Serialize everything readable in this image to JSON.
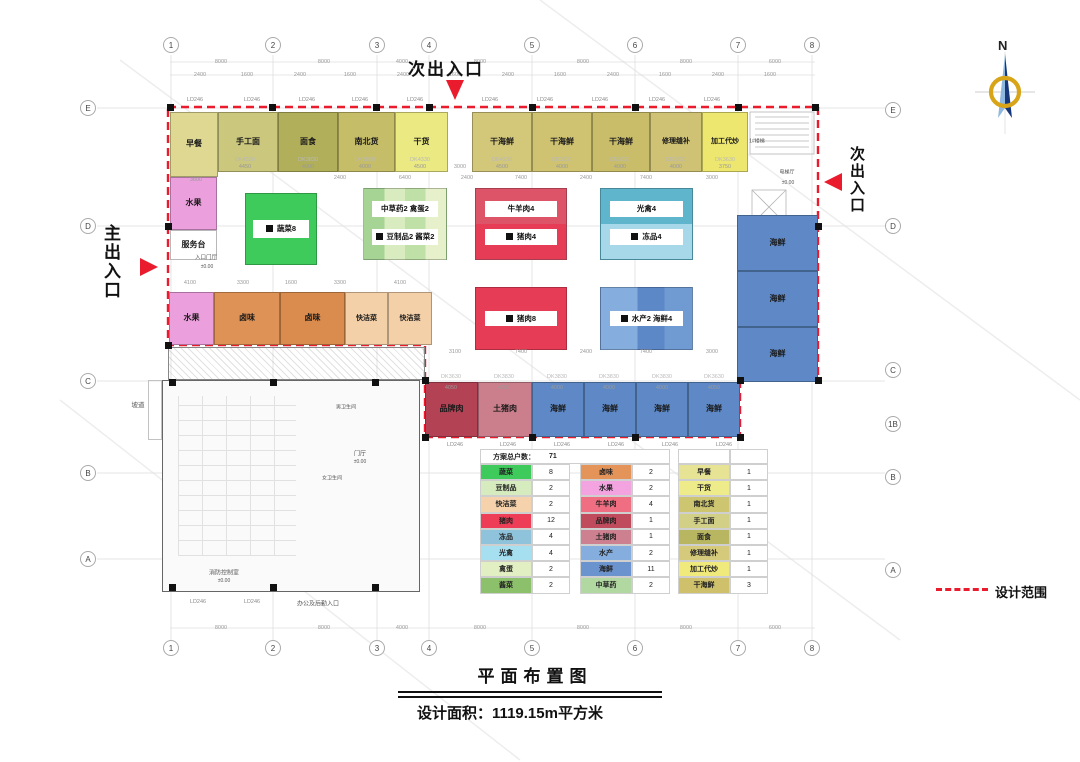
{
  "page": {
    "north_label": "N",
    "legend_label": "设计范围",
    "title": "平面布置图",
    "area_text": "设计面积：1119.15m平方米"
  },
  "entrances": {
    "top": "次出入口",
    "right": "次出入口",
    "left": "主出入口"
  },
  "grid": {
    "top": [
      {
        "n": "1",
        "x": 171
      },
      {
        "n": "2",
        "x": 273
      },
      {
        "n": "3",
        "x": 377
      },
      {
        "n": "4",
        "x": 429
      },
      {
        "n": "5",
        "x": 532
      },
      {
        "n": "6",
        "x": 635
      },
      {
        "n": "7",
        "x": 738
      },
      {
        "n": "8",
        "x": 812
      }
    ],
    "bottom": [
      {
        "n": "1",
        "x": 171
      },
      {
        "n": "2",
        "x": 273
      },
      {
        "n": "3",
        "x": 377
      },
      {
        "n": "4",
        "x": 429
      },
      {
        "n": "5",
        "x": 532
      },
      {
        "n": "6",
        "x": 635
      },
      {
        "n": "7",
        "x": 738
      },
      {
        "n": "8",
        "x": 812
      }
    ],
    "left": [
      {
        "n": "E",
        "y": 108
      },
      {
        "n": "D",
        "y": 226
      },
      {
        "n": "C",
        "y": 381
      },
      {
        "n": "B",
        "y": 473
      },
      {
        "n": "A",
        "y": 559
      }
    ],
    "right": [
      {
        "n": "E",
        "y": 110
      },
      {
        "n": "D",
        "y": 226
      },
      {
        "n": "C",
        "y": 370
      },
      {
        "n": "1B",
        "y": 424
      },
      {
        "n": "B",
        "y": 477
      },
      {
        "n": "A",
        "y": 570
      }
    ]
  },
  "plan": {
    "boundary_color": "#ea1b2d",
    "stalls": [
      {
        "label": "早餐",
        "x": 170,
        "y": 112,
        "w": 48,
        "h": 65,
        "bg": "#ded892"
      },
      {
        "label": "手工面",
        "x": 218,
        "y": 112,
        "w": 60,
        "h": 60,
        "bg": "#cbc77c"
      },
      {
        "label": "面食",
        "x": 278,
        "y": 112,
        "w": 60,
        "h": 60,
        "bg": "#b2af5a"
      },
      {
        "label": "南北货",
        "x": 338,
        "y": 112,
        "w": 57,
        "h": 60,
        "bg": "#c6bd69"
      },
      {
        "label": "干货",
        "x": 395,
        "y": 112,
        "w": 53,
        "h": 60,
        "bg": "#ebe982"
      },
      {
        "label": "干海鲜",
        "x": 472,
        "y": 112,
        "w": 60,
        "h": 60,
        "bg": "#d3c77a"
      },
      {
        "label": "干海鲜",
        "x": 532,
        "y": 112,
        "w": 60,
        "h": 60,
        "bg": "#cfc372"
      },
      {
        "label": "干海鲜",
        "x": 592,
        "y": 112,
        "w": 58,
        "h": 60,
        "bg": "#c9bd6a"
      },
      {
        "label": "修理缝补",
        "x": 650,
        "y": 112,
        "w": 52,
        "h": 60,
        "bg": "#cfc275",
        "fs": 7
      },
      {
        "label": "加工代炒",
        "x": 702,
        "y": 112,
        "w": 46,
        "h": 60,
        "bg": "#ede76f",
        "fs": 7
      },
      {
        "label": "水果",
        "x": 170,
        "y": 177,
        "w": 47,
        "h": 53,
        "bg": "#eb9fdc"
      },
      {
        "label": "服务台",
        "x": 170,
        "y": 230,
        "w": 47,
        "h": 30,
        "bg": "#ffffff"
      },
      {
        "label": "水果",
        "x": 169,
        "y": 292,
        "w": 45,
        "h": 53,
        "bg": "#eb9fdc"
      },
      {
        "label": "卤味",
        "x": 214,
        "y": 292,
        "w": 66,
        "h": 53,
        "bg": "#de9256"
      },
      {
        "label": "卤味",
        "x": 280,
        "y": 292,
        "w": 65,
        "h": 53,
        "bg": "#d98c4e"
      },
      {
        "label": "快洁菜",
        "x": 345,
        "y": 292,
        "w": 43,
        "h": 53,
        "bg": "#f4d0a8",
        "fs": 7
      },
      {
        "label": "快洁菜",
        "x": 388,
        "y": 292,
        "w": 44,
        "h": 53,
        "bg": "#f4d0a8",
        "fs": 7
      },
      {
        "label": "品牌肉",
        "x": 425,
        "y": 382,
        "w": 53,
        "h": 55,
        "bg": "#b24254"
      },
      {
        "label": "土猪肉",
        "x": 478,
        "y": 382,
        "w": 54,
        "h": 55,
        "bg": "#cb7f8d"
      },
      {
        "label": "海鲜",
        "x": 532,
        "y": 382,
        "w": 52,
        "h": 55,
        "bg": "#5e89c6"
      },
      {
        "label": "海鲜",
        "x": 584,
        "y": 382,
        "w": 52,
        "h": 55,
        "bg": "#5e89c6"
      },
      {
        "label": "海鲜",
        "x": 636,
        "y": 382,
        "w": 52,
        "h": 55,
        "bg": "#5e89c6"
      },
      {
        "label": "海鲜",
        "x": 688,
        "y": 382,
        "w": 52,
        "h": 55,
        "bg": "#5e89c6"
      },
      {
        "label": "海鲜",
        "x": 737,
        "y": 215,
        "w": 81,
        "h": 56,
        "bg": "#5e89c6"
      },
      {
        "label": "海鲜",
        "x": 737,
        "y": 271,
        "w": 81,
        "h": 56,
        "bg": "#5e89c6"
      },
      {
        "label": "海鲜",
        "x": 737,
        "y": 327,
        "w": 81,
        "h": 55,
        "bg": "#5e89c6"
      }
    ],
    "islands": [
      {
        "labels": [
          "蔬菜8"
        ],
        "x": 245,
        "y": 193,
        "w": 72,
        "h": 72,
        "bg": "#3fcb5c"
      },
      {
        "labels": [
          "中草药2  禽蛋2",
          "豆制品2  酱菜2"
        ],
        "x": 363,
        "y": 188,
        "w": 84,
        "h": 72,
        "bg": "linear-gradient(90deg,#a6d494 0 25%,#d9ecc0 0 50%,#bfe0a6 0 75%,#e6f0ca 0 100%)"
      },
      {
        "labels": [
          "牛羊肉4",
          "猪肉4"
        ],
        "x": 475,
        "y": 188,
        "w": 92,
        "h": 72,
        "bg": "#dd5368",
        "bg2": "#e63c55"
      },
      {
        "labels": [
          "光禽4",
          "冻品4"
        ],
        "x": 600,
        "y": 188,
        "w": 93,
        "h": 72,
        "bg": "#5fb6cc",
        "bg2": "#a7d8e9"
      },
      {
        "labels": [
          "猪肉8"
        ],
        "x": 475,
        "y": 287,
        "w": 92,
        "h": 63,
        "bg": "#e63c55"
      },
      {
        "labels": [
          "水产2  海鲜4"
        ],
        "x": 600,
        "y": 287,
        "w": 93,
        "h": 63,
        "bg": "linear-gradient(90deg,#85aede 0 40%,#5c88c8 0 70%,#6f9ad2 0 100%)"
      }
    ],
    "columns": [
      [
        170,
        107
      ],
      [
        272,
        107
      ],
      [
        376,
        107
      ],
      [
        429,
        107
      ],
      [
        532,
        107
      ],
      [
        635,
        107
      ],
      [
        738,
        107
      ],
      [
        815,
        107
      ],
      [
        168,
        226
      ],
      [
        168,
        345
      ],
      [
        818,
        226
      ],
      [
        818,
        380
      ],
      [
        740,
        380
      ],
      [
        425,
        380
      ],
      [
        425,
        437
      ],
      [
        532,
        437
      ],
      [
        635,
        437
      ],
      [
        740,
        437
      ],
      [
        172,
        382
      ],
      [
        273,
        382
      ],
      [
        375,
        382
      ],
      [
        172,
        587
      ],
      [
        273,
        587
      ],
      [
        375,
        587
      ]
    ],
    "window_labels": [
      {
        "t": "LD246",
        "x": 195,
        "y": 100
      },
      {
        "t": "LD246",
        "x": 252,
        "y": 100
      },
      {
        "t": "LD246",
        "x": 307,
        "y": 100
      },
      {
        "t": "LD246",
        "x": 360,
        "y": 100
      },
      {
        "t": "LD246",
        "x": 415,
        "y": 100
      },
      {
        "t": "LD246",
        "x": 490,
        "y": 100
      },
      {
        "t": "LD246",
        "x": 545,
        "y": 100
      },
      {
        "t": "LD246",
        "x": 600,
        "y": 100
      },
      {
        "t": "LD246",
        "x": 657,
        "y": 100
      },
      {
        "t": "LD246",
        "x": 712,
        "y": 100
      },
      {
        "t": "LD246",
        "x": 455,
        "y": 445
      },
      {
        "t": "LD246",
        "x": 508,
        "y": 445
      },
      {
        "t": "LD246",
        "x": 562,
        "y": 445
      },
      {
        "t": "LD246",
        "x": 616,
        "y": 445
      },
      {
        "t": "LD246",
        "x": 670,
        "y": 445
      },
      {
        "t": "LD246",
        "x": 724,
        "y": 445
      },
      {
        "t": "LD246",
        "x": 198,
        "y": 602
      },
      {
        "t": "LD246",
        "x": 252,
        "y": 602
      }
    ],
    "dk_labels": [
      {
        "t": "DK4330",
        "x": 245,
        "y": 160
      },
      {
        "t": "DK3830",
        "x": 308,
        "y": 160
      },
      {
        "t": "DK3830",
        "x": 365,
        "y": 160
      },
      {
        "t": "DK4330",
        "x": 420,
        "y": 160
      },
      {
        "t": "DK4330",
        "x": 502,
        "y": 160
      },
      {
        "t": "DK3830",
        "x": 562,
        "y": 160
      },
      {
        "t": "DK3830",
        "x": 620,
        "y": 160
      },
      {
        "t": "DK3830",
        "x": 676,
        "y": 160
      },
      {
        "t": "DK3630",
        "x": 725,
        "y": 160
      },
      {
        "t": "DK3630",
        "x": 451,
        "y": 377
      },
      {
        "t": "DK3830",
        "x": 504,
        "y": 377
      },
      {
        "t": "DK3830",
        "x": 557,
        "y": 377
      },
      {
        "t": "DK3830",
        "x": 609,
        "y": 377
      },
      {
        "t": "DK3830",
        "x": 662,
        "y": 377
      },
      {
        "t": "DK3630",
        "x": 714,
        "y": 377
      }
    ],
    "dims": [
      {
        "t": "8000",
        "x": 221,
        "y": 62
      },
      {
        "t": "8000",
        "x": 324,
        "y": 62
      },
      {
        "t": "4000",
        "x": 402,
        "y": 62
      },
      {
        "t": "8000",
        "x": 480,
        "y": 62
      },
      {
        "t": "8000",
        "x": 583,
        "y": 62
      },
      {
        "t": "8000",
        "x": 686,
        "y": 62
      },
      {
        "t": "6000",
        "x": 775,
        "y": 62
      },
      {
        "t": "2400",
        "x": 200,
        "y": 75
      },
      {
        "t": "1600",
        "x": 247,
        "y": 75
      },
      {
        "t": "2400",
        "x": 300,
        "y": 75
      },
      {
        "t": "1600",
        "x": 350,
        "y": 75
      },
      {
        "t": "2400",
        "x": 403,
        "y": 75
      },
      {
        "t": "1600",
        "x": 455,
        "y": 75
      },
      {
        "t": "2400",
        "x": 508,
        "y": 75
      },
      {
        "t": "1600",
        "x": 560,
        "y": 75
      },
      {
        "t": "2400",
        "x": 613,
        "y": 75
      },
      {
        "t": "1600",
        "x": 665,
        "y": 75
      },
      {
        "t": "2400",
        "x": 718,
        "y": 75
      },
      {
        "t": "1600",
        "x": 770,
        "y": 75
      },
      {
        "t": "4450",
        "x": 245,
        "y": 167
      },
      {
        "t": "4000",
        "x": 308,
        "y": 167
      },
      {
        "t": "4000",
        "x": 365,
        "y": 167
      },
      {
        "t": "4500",
        "x": 420,
        "y": 167
      },
      {
        "t": "3000",
        "x": 460,
        "y": 167
      },
      {
        "t": "4500",
        "x": 502,
        "y": 167
      },
      {
        "t": "4000",
        "x": 562,
        "y": 167
      },
      {
        "t": "4000",
        "x": 620,
        "y": 167
      },
      {
        "t": "4000",
        "x": 676,
        "y": 167
      },
      {
        "t": "3750",
        "x": 725,
        "y": 167
      },
      {
        "t": "3600",
        "x": 196,
        "y": 180
      },
      {
        "t": "2400",
        "x": 340,
        "y": 178
      },
      {
        "t": "6400",
        "x": 405,
        "y": 178
      },
      {
        "t": "2400",
        "x": 467,
        "y": 178
      },
      {
        "t": "7400",
        "x": 521,
        "y": 178
      },
      {
        "t": "2400",
        "x": 586,
        "y": 178
      },
      {
        "t": "7400",
        "x": 646,
        "y": 178
      },
      {
        "t": "3000",
        "x": 712,
        "y": 178
      },
      {
        "t": "4100",
        "x": 190,
        "y": 283
      },
      {
        "t": "3300",
        "x": 243,
        "y": 283
      },
      {
        "t": "1600",
        "x": 291,
        "y": 283
      },
      {
        "t": "3300",
        "x": 340,
        "y": 283
      },
      {
        "t": "4100",
        "x": 400,
        "y": 283
      },
      {
        "t": "3100",
        "x": 455,
        "y": 352
      },
      {
        "t": "7400",
        "x": 521,
        "y": 352
      },
      {
        "t": "2400",
        "x": 586,
        "y": 352
      },
      {
        "t": "7400",
        "x": 646,
        "y": 352
      },
      {
        "t": "3000",
        "x": 712,
        "y": 352
      },
      {
        "t": "4050",
        "x": 451,
        "y": 388
      },
      {
        "t": "4000",
        "x": 504,
        "y": 388
      },
      {
        "t": "4000",
        "x": 557,
        "y": 388
      },
      {
        "t": "4000",
        "x": 609,
        "y": 388
      },
      {
        "t": "4000",
        "x": 662,
        "y": 388
      },
      {
        "t": "4050",
        "x": 714,
        "y": 388
      },
      {
        "t": "8000",
        "x": 221,
        "y": 628
      },
      {
        "t": "8000",
        "x": 324,
        "y": 628
      },
      {
        "t": "4000",
        "x": 402,
        "y": 628
      },
      {
        "t": "8000",
        "x": 480,
        "y": 628
      },
      {
        "t": "8000",
        "x": 583,
        "y": 628
      },
      {
        "t": "8000",
        "x": 686,
        "y": 628
      },
      {
        "t": "6000",
        "x": 775,
        "y": 628
      }
    ],
    "rooms": [
      {
        "t": "坡道",
        "x": 138,
        "y": 404,
        "fs": 6.5
      },
      {
        "t": "办公及后勤入口",
        "x": 318,
        "y": 603,
        "fs": 6
      },
      {
        "t": "消防控制室",
        "x": 224,
        "y": 572,
        "fs": 6
      },
      {
        "t": "±0.00",
        "x": 224,
        "y": 581,
        "fs": 5
      },
      {
        "t": "门厅",
        "x": 360,
        "y": 453,
        "fs": 6
      },
      {
        "t": "±0.00",
        "x": 360,
        "y": 462,
        "fs": 5
      },
      {
        "t": "男卫生间",
        "x": 346,
        "y": 407,
        "fs": 5
      },
      {
        "t": "女卫生间",
        "x": 332,
        "y": 478,
        "fs": 5
      },
      {
        "t": "1#楼梯",
        "x": 757,
        "y": 141,
        "fs": 5
      },
      {
        "t": "电梯厅",
        "x": 787,
        "y": 172,
        "fs": 5
      },
      {
        "t": "±0.00",
        "x": 788,
        "y": 183,
        "fs": 5
      },
      {
        "t": "入口门厅",
        "x": 206,
        "y": 257,
        "fs": 5.5
      },
      {
        "t": "±0.00",
        "x": 207,
        "y": 267,
        "fs": 5
      }
    ]
  },
  "table": {
    "header_label": "方案总户数：",
    "header_value": "71",
    "groups": [
      [
        {
          "name": "蔬菜",
          "count": "8",
          "color": "#3fcb5c"
        },
        {
          "name": "豆制品",
          "count": "2",
          "color": "#d6ecbe"
        },
        {
          "name": "快洁菜",
          "count": "2",
          "color": "#f5d2ab"
        },
        {
          "name": "猪肉",
          "count": "12",
          "color": "#ee3e57"
        },
        {
          "name": "冻品",
          "count": "4",
          "color": "#8fc3dc"
        },
        {
          "name": "光禽",
          "count": "4",
          "color": "#a5dff0"
        },
        {
          "name": "禽蛋",
          "count": "2",
          "color": "#e2efc2"
        },
        {
          "name": "酱菜",
          "count": "2",
          "color": "#8cc06a"
        }
      ],
      [
        {
          "name": "卤味",
          "count": "2",
          "color": "#e49359"
        },
        {
          "name": "水果",
          "count": "2",
          "color": "#f2a3e0"
        },
        {
          "name": "牛羊肉",
          "count": "4",
          "color": "#ef6e82"
        },
        {
          "name": "品牌肉",
          "count": "1",
          "color": "#c04b5c"
        },
        {
          "name": "土猪肉",
          "count": "1",
          "color": "#cc8090"
        },
        {
          "name": "水产",
          "count": "2",
          "color": "#85aede"
        },
        {
          "name": "海鲜",
          "count": "11",
          "color": "#6b94cf"
        },
        {
          "name": "中草药",
          "count": "2",
          "color": "#b2d8a2"
        }
      ],
      [
        {
          "name": "早餐",
          "count": "1",
          "color": "#e7e394"
        },
        {
          "name": "干货",
          "count": "1",
          "color": "#eeec8a"
        },
        {
          "name": "南北货",
          "count": "1",
          "color": "#cdc56f"
        },
        {
          "name": "手工面",
          "count": "1",
          "color": "#d2cf86"
        },
        {
          "name": "面食",
          "count": "1",
          "color": "#b9b661"
        },
        {
          "name": "修理缝补",
          "count": "1",
          "color": "#d5c97b"
        },
        {
          "name": "加工代炒",
          "count": "1",
          "color": "#f0e97b"
        },
        {
          "name": "干海鲜",
          "count": "3",
          "color": "#cfc06b"
        }
      ]
    ]
  }
}
